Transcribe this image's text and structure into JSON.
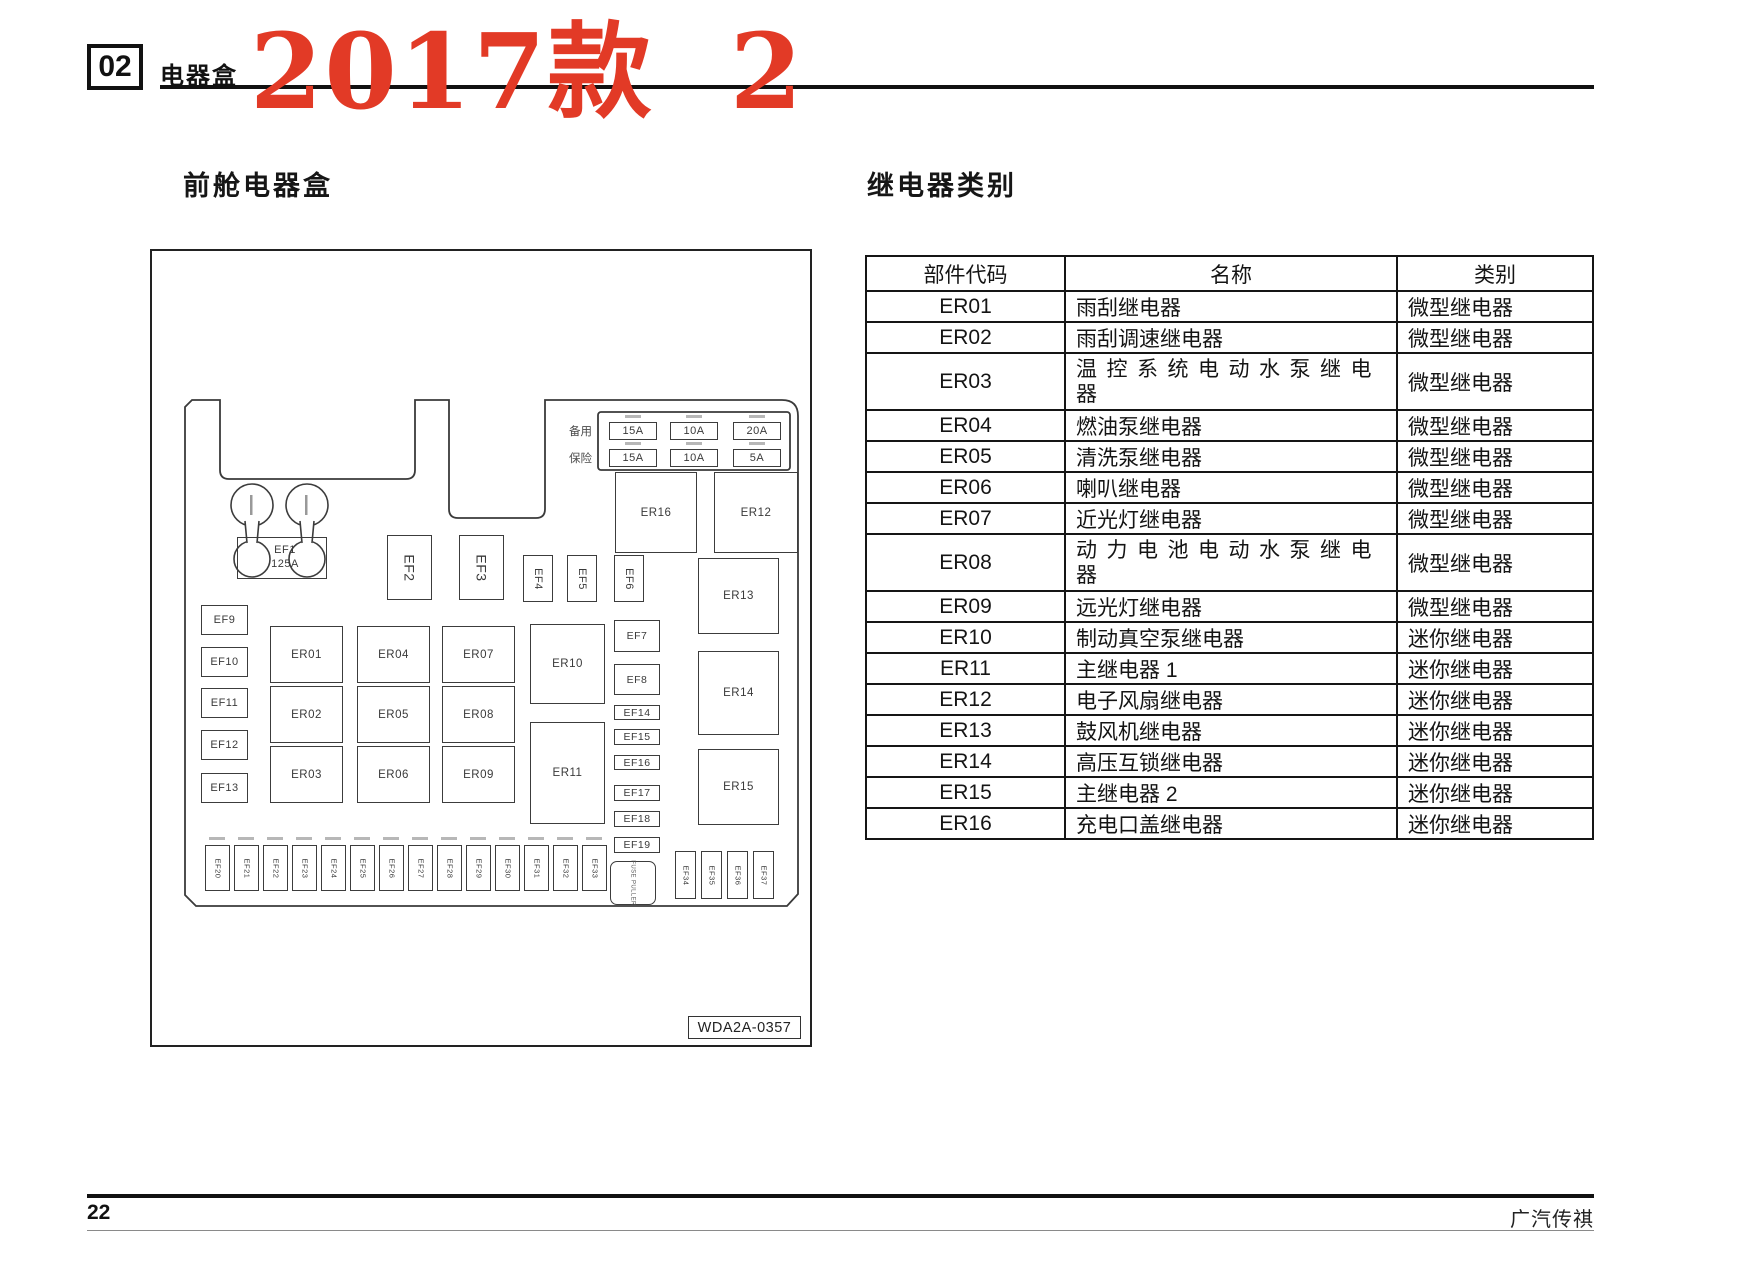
{
  "page": {
    "chapter_number": "02",
    "chapter_label": "电器盒",
    "model_year_mark": "2017款  2",
    "left_section_title": "前舱电器盒",
    "right_section_title": "继电器类别",
    "page_number": "22",
    "brand": "广汽传祺",
    "accent_red": "#e23a26"
  },
  "diagram": {
    "spare_label": "备用",
    "fuse_label": "保险",
    "panel_fuses_row1": [
      "15A",
      "10A",
      "20A"
    ],
    "panel_fuses_row2": [
      "15A",
      "10A",
      "5A"
    ],
    "main_fuse": {
      "code": "EF1",
      "rating": "125A"
    },
    "vertical_fuses": [
      "EF2",
      "EF3",
      "EF4",
      "EF5",
      "EF6"
    ],
    "left_fuses": [
      "EF9",
      "EF10",
      "EF11",
      "EF12",
      "EF13"
    ],
    "relay_grid": [
      "ER01",
      "ER02",
      "ER03",
      "ER04",
      "ER05",
      "ER06",
      "ER07",
      "ER08",
      "ER09"
    ],
    "relay_er10": "ER10",
    "relay_er11": "ER11",
    "relay_er16": "ER16",
    "relay_er12": "ER12",
    "mid_fuses": [
      "EF7",
      "EF8",
      "EF14",
      "EF15",
      "EF16",
      "EF17",
      "EF18",
      "EF19"
    ],
    "right_relays": [
      "ER13",
      "ER14",
      "ER15"
    ],
    "bottom_fuses": [
      "EF20",
      "EF21",
      "EF22",
      "EF23",
      "EF24",
      "EF25",
      "EF26",
      "EF27",
      "EF28",
      "EF29",
      "EF30",
      "EF31",
      "EF32",
      "EF33"
    ],
    "bottom_fuses_right": [
      "EF34",
      "EF35",
      "EF36",
      "EF37"
    ],
    "fuse_puller": "FUSE PULLER",
    "drawing_code": "WDA2A-0357"
  },
  "table": {
    "headers": [
      "部件代码",
      "名称",
      "类别"
    ],
    "rows": [
      [
        "ER01",
        "雨刮继电器",
        "微型继电器"
      ],
      [
        "ER02",
        "雨刮调速继电器",
        "微型继电器"
      ],
      [
        "ER03",
        "温控系统电动水泵继电器",
        "微型继电器"
      ],
      [
        "ER04",
        "燃油泵继电器",
        "微型继电器"
      ],
      [
        "ER05",
        "清洗泵继电器",
        "微型继电器"
      ],
      [
        "ER06",
        "喇叭继电器",
        "微型继电器"
      ],
      [
        "ER07",
        "近光灯继电器",
        "微型继电器"
      ],
      [
        "ER08",
        "动力电池电动水泵继电器",
        "微型继电器"
      ],
      [
        "ER09",
        "远光灯继电器",
        "微型继电器"
      ],
      [
        "ER10",
        "制动真空泵继电器",
        "迷你继电器"
      ],
      [
        "ER11",
        "主继电器 1",
        "迷你继电器"
      ],
      [
        "ER12",
        "电子风扇继电器",
        "迷你继电器"
      ],
      [
        "ER13",
        "鼓风机继电器",
        "迷你继电器"
      ],
      [
        "ER14",
        "高压互锁继电器",
        "迷你继电器"
      ],
      [
        "ER15",
        "主继电器 2",
        "迷你继电器"
      ],
      [
        "ER16",
        "充电口盖继电器",
        "迷你继电器"
      ]
    ]
  }
}
